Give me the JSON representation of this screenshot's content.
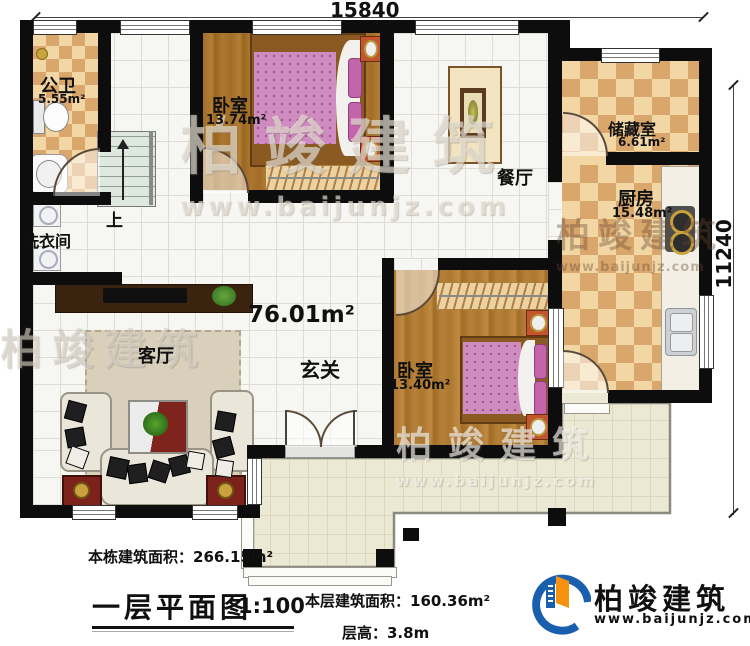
{
  "dimensions": {
    "top": "15840",
    "right": "11240"
  },
  "rooms": {
    "bathroom": {
      "name": "公卫",
      "area": "5.55m²"
    },
    "laundry": {
      "name": "洗衣间"
    },
    "stairs": {
      "label": "上"
    },
    "bedroom1": {
      "name": "卧室",
      "area": "13.74m²"
    },
    "dining": {
      "name": "餐厅"
    },
    "storage": {
      "name": "储藏室",
      "area": "6.61m²"
    },
    "kitchen": {
      "name": "厨房",
      "area": "15.48m²"
    },
    "hall": {
      "name": "玄关",
      "area": "76.01m²"
    },
    "living": {
      "name": "客厅"
    },
    "bedroom2": {
      "name": "卧室",
      "area": "13.40m²"
    }
  },
  "annotations": {
    "building_area": "本栋建筑面积：266.15m²",
    "plan_title": "一层平面图",
    "plan_scale": "1:100",
    "floor_area": "本层建筑面积：160.36m²",
    "floor_height": "层高：3.8m"
  },
  "brand": {
    "name": "柏竣建筑",
    "website": "www.baijunjz.com"
  },
  "watermark": {
    "name": "柏竣建筑",
    "website": "www.baijunjz.com"
  },
  "colors": {
    "wall": "#0d0d0d",
    "brand_blue": "#1a5fae",
    "brand_orange": "#f6920e",
    "bed_pink": "#cf8cc0",
    "checker_dark": "#d9a76c",
    "checker_light": "#f2d7a4"
  }
}
